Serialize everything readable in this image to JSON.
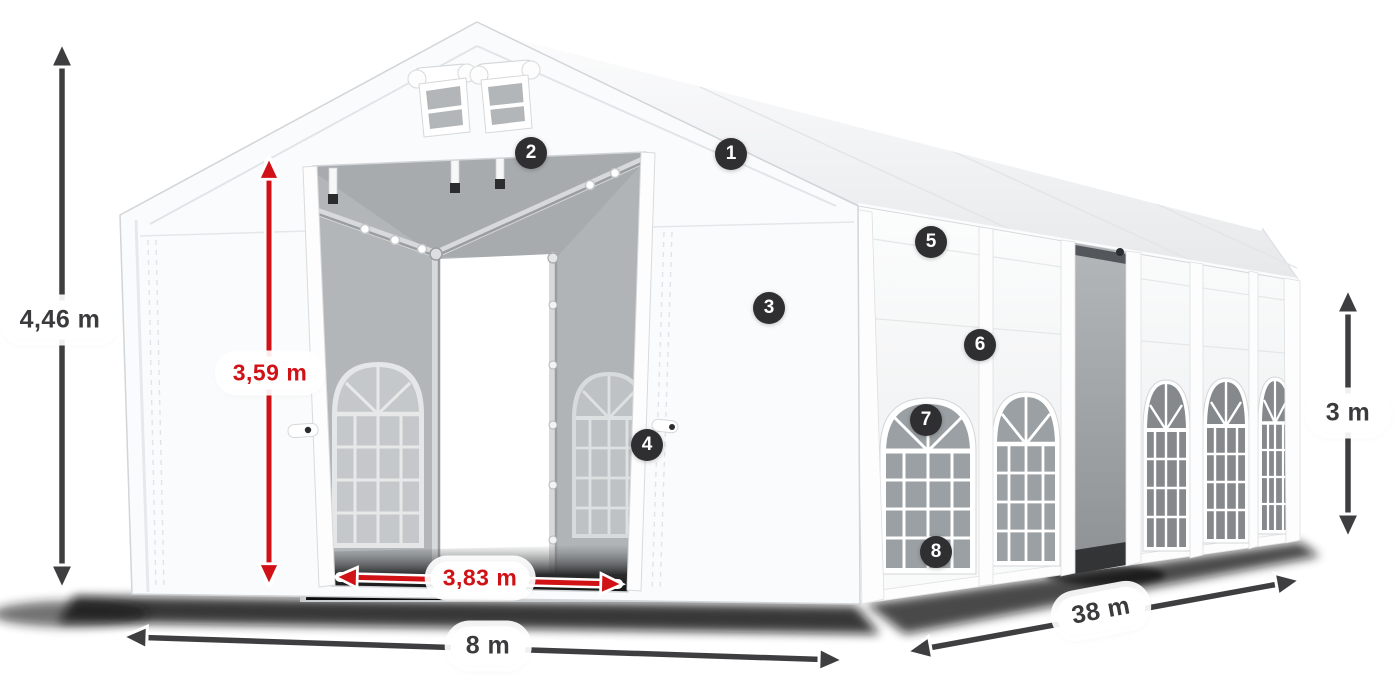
{
  "figure": {
    "title": "Marquee tent dimension diagram",
    "dimensions": {
      "total_height": "4,46 m",
      "entrance_height": "3,59 m",
      "entrance_width": "3,83 m",
      "tent_width": "8 m",
      "tent_length": "38 m",
      "side_height": "3 m"
    },
    "callouts": [
      {
        "number": "1"
      },
      {
        "number": "2"
      },
      {
        "number": "3"
      },
      {
        "number": "4"
      },
      {
        "number": "5"
      },
      {
        "number": "6"
      },
      {
        "number": "7"
      },
      {
        "number": "8"
      }
    ],
    "colors": {
      "dimension_arrow": "#3e3e40",
      "dimension_red": "#d01217",
      "badge_background": "#2f2f31",
      "badge_text": "#ffffff",
      "label_background": "#ffffff",
      "label_text": "#3b3b3d",
      "tent_fabric": "#fafbfc",
      "interior_gray": "#b4b8bb"
    }
  }
}
